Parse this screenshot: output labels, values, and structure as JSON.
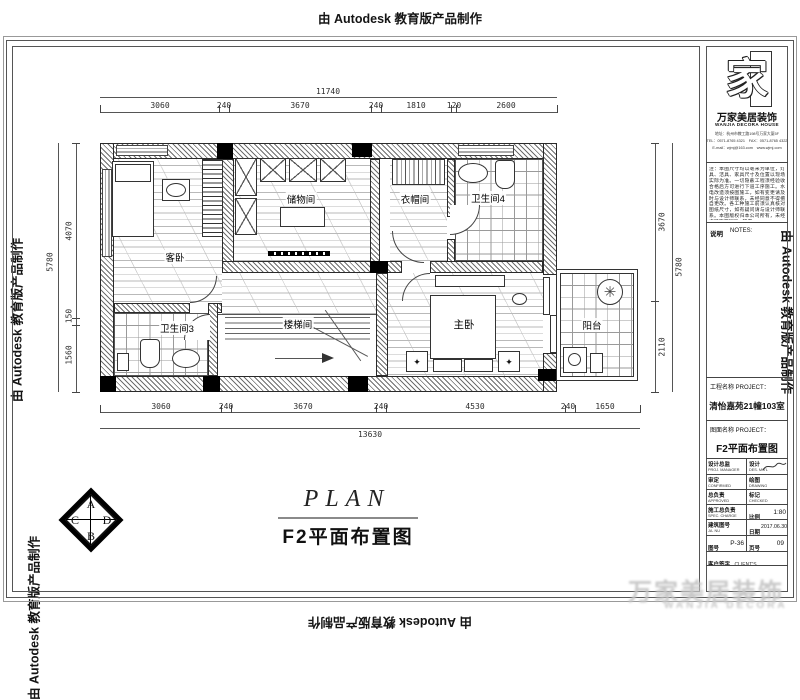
{
  "stamp_text": "由 Autodesk 教育版产品制作",
  "plan_title": {
    "en": "PLAN",
    "cn": "F2平面布置图"
  },
  "rooms": {
    "guest_bedroom": "客卧",
    "storage": "储物间",
    "cloakroom": "衣帽间",
    "bathroom4": "卫生间4",
    "bathroom3": "卫生间3",
    "stairwell": "楼梯间",
    "master_bedroom": "主卧",
    "balcony": "阳台"
  },
  "dims": {
    "top_total": "11740",
    "top_chain": [
      "3060",
      "240",
      "3670",
      "240",
      "1810",
      "120",
      "2600"
    ],
    "bottom_chain": [
      "3060",
      "240",
      "3670",
      "240",
      "4530",
      "240",
      "1650"
    ],
    "bottom_total": "13630",
    "left_chain": [
      "4070",
      "150",
      "1560"
    ],
    "left_total": "5780",
    "right_chain": [
      "3670",
      "2110"
    ],
    "right_total": "5780"
  },
  "cabd": {
    "a": "A",
    "b": "B",
    "c": "C",
    "d": "D"
  },
  "icons": {
    "ornament": "✦",
    "plant": "✳"
  },
  "sidebar": {
    "logo_char": "家",
    "company_cn": "万家美居装饰",
    "company_en": "WANJIA DECORA HOUSE",
    "address_lines": [
      "地址：杭州市教工路198号万家大厦5F",
      "TEL：0571-8765 4321　FAX：0571-8765 4322",
      "E-mail：wjmj@163.com　www.wjmj.com"
    ],
    "notes": "注：本图尺寸均以毫米为单位，灯具、洁具、家具尺寸及位置以现场实际为准。一切隐蔽工程须经验收合格后方可进行下道工序施工。水电改造须按图施工，如有变更请及时与设计师联系，未经同意不得擅自更改。各工种施工前须认真核对图纸尺寸，如有疑问请与设计师联系。本图版权归本公司所有，未经许可不得翻印、转借。",
    "notes_label_cn": "说明",
    "notes_label_en": "NOTES:",
    "project_label": "工程名称 PROJECT：",
    "project_value": "清怡嘉苑21幢103室",
    "drawing_label": "图面名称 PROJECT：",
    "drawing_value": "F2平面布置图",
    "table": {
      "r1l_cn": "设计总监",
      "r1l_en": "PROJ. MANAGER",
      "r1r_cn": "设计",
      "r1r_en": "DES. MG'L",
      "r2l_cn": "审定",
      "r2l_en": "CONFIRMED",
      "r2r_cn": "绘图",
      "r2r_en": "DRAWING",
      "r3l_cn": "总负责",
      "r3l_en": "APPROVED",
      "r3r_cn": "标记",
      "r3r_en": "CHECKED",
      "r4l_cn": "施工总负责",
      "r4l_en": "SPEC. CHARGE",
      "r4r_cn": "比例",
      "r4r_en": "SCALE",
      "scale": "1:80",
      "r5l_cn": "建筑图号",
      "r5l_en": "JA. NU",
      "r5r_cn": "日期",
      "r5r_en": "DATE",
      "date": "2017.06.30",
      "r6l_cn": "图号",
      "r6l_en": "DWG No.",
      "dwg_no": "P-36",
      "r6r_cn": "页号",
      "r6r_en": "NU",
      "page_no": "09",
      "r7_cn": "客户签字",
      "r7_en": "CLIENT'S"
    }
  },
  "watermark_grey": {
    "line1": "万家美居装饰",
    "line2": "WANJIA DECORA"
  }
}
